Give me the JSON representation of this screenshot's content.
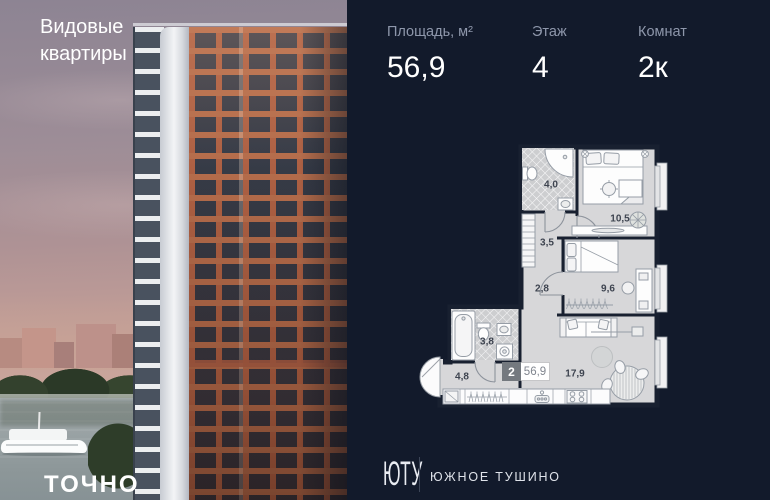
{
  "photo": {
    "headline": "Видовые квартиры",
    "brand": "ТОЧНО"
  },
  "stats": {
    "area": {
      "label": "Площадь, м²",
      "value": "56,9"
    },
    "floor": {
      "label": "Этаж",
      "value": "4"
    },
    "rooms": {
      "label": "Комнат",
      "value": "2к"
    }
  },
  "plan": {
    "badge": {
      "rooms": "2",
      "area": "56,9"
    },
    "rooms": [
      {
        "name": "bathroom-1",
        "area": "4,0"
      },
      {
        "name": "bedroom-1",
        "area": "10,5"
      },
      {
        "name": "hallway",
        "area": "3,5"
      },
      {
        "name": "corridor",
        "area": "2,8"
      },
      {
        "name": "bedroom-2",
        "area": "9,6"
      },
      {
        "name": "bathroom-2",
        "area": "3,8"
      },
      {
        "name": "entry-hall",
        "area": "4,8"
      },
      {
        "name": "kitchen-living",
        "area": "17,9"
      }
    ]
  },
  "footer": {
    "logo": "ЮТУ",
    "district": "ЮЖНОЕ ТУШИНО"
  },
  "colors": {
    "panel_bg": "#121a2b",
    "plan_room_fill": "#d7d7d9",
    "plan_wall": "#182030",
    "facade_terracotta": "#ad6043"
  }
}
